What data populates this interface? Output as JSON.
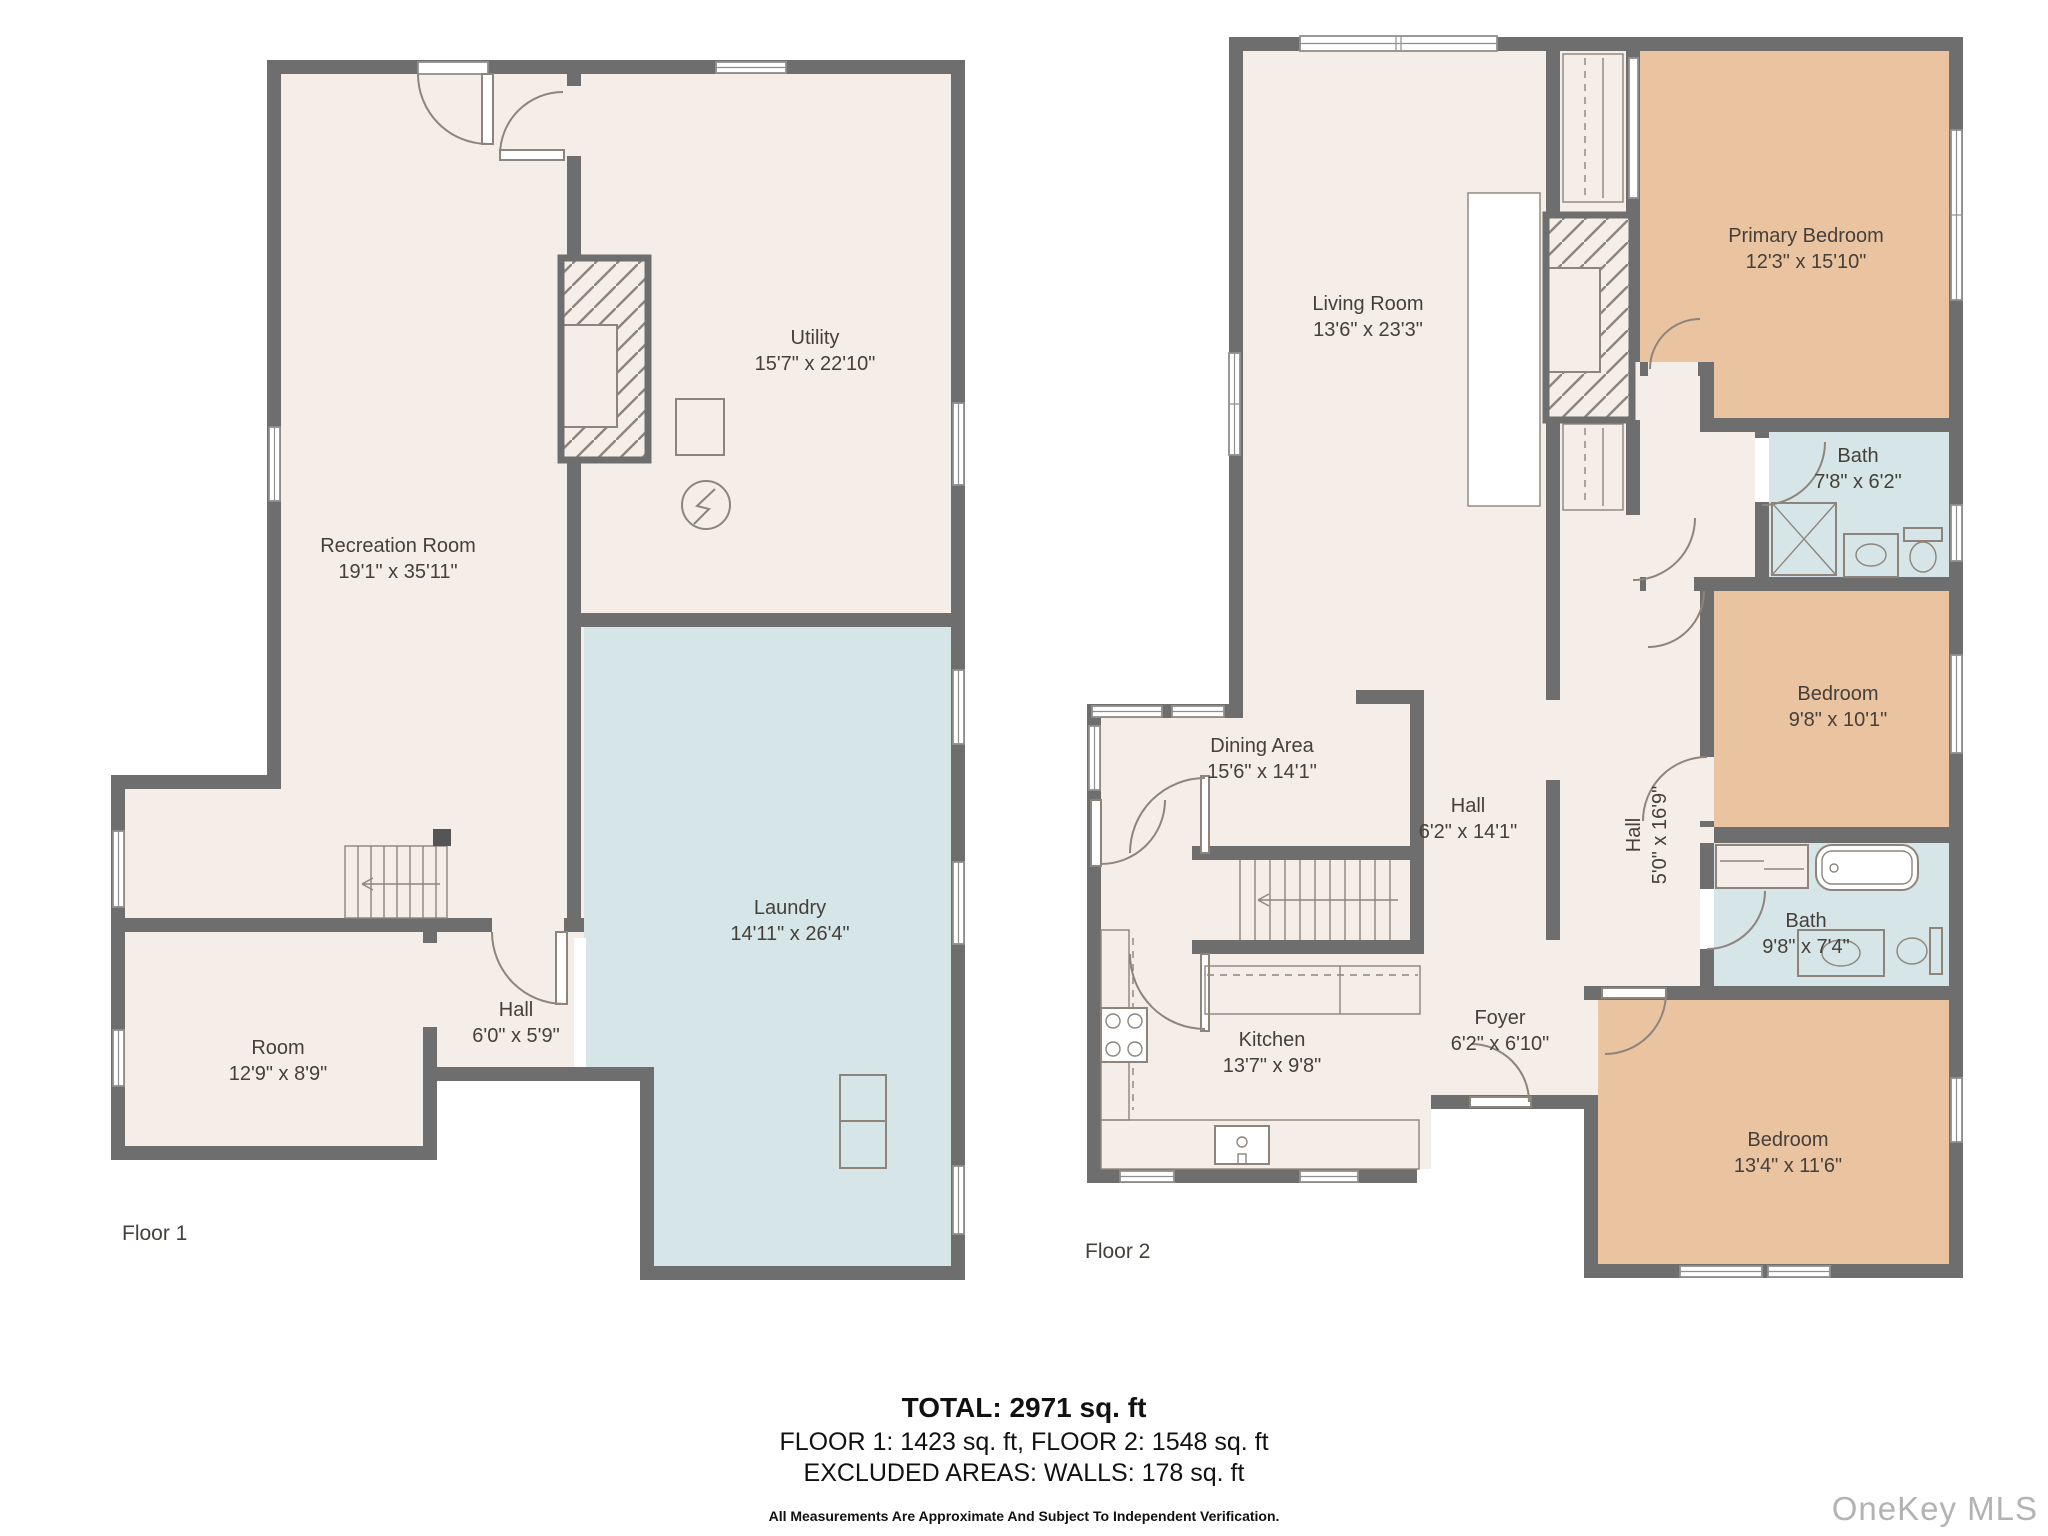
{
  "watermark": {
    "text": "OneKey MLS"
  },
  "colors": {
    "cream": "#f5ede7",
    "tan": "#eac3a1",
    "blue": "#d6e5e8",
    "wall": "#6e6e6e",
    "line": "#8d857c",
    "winstroke": "#8f8f8f",
    "text": "#45403a",
    "watermark": "#b3b3b3"
  },
  "floor1": {
    "label": "Floor 1",
    "rooms": [
      {
        "name": "Recreation Room",
        "dims": "19'1\" x 35'11\""
      },
      {
        "name": "Utility",
        "dims": "15'7\" x 22'10\""
      },
      {
        "name": "Laundry",
        "dims": "14'11\" x 26'4\""
      },
      {
        "name": "Hall",
        "dims": "6'0\" x 5'9\""
      },
      {
        "name": "Room",
        "dims": "12'9\" x 8'9\""
      }
    ]
  },
  "floor2": {
    "label": "Floor 2",
    "rooms": [
      {
        "name": "Living Room",
        "dims": "13'6\" x 23'3\""
      },
      {
        "name": "Primary Bedroom",
        "dims": "12'3\" x 15'10\""
      },
      {
        "name": "Bath",
        "dims": "7'8\" x 6'2\""
      },
      {
        "name": "Bedroom",
        "dims": "9'8\" x 10'1\""
      },
      {
        "name": "Dining Area",
        "dims": "15'6\" x 14'1\""
      },
      {
        "name": "Hall",
        "dims": "6'2\" x 14'1\""
      },
      {
        "name": "Hall",
        "dims": "5'0\" x 16'9\""
      },
      {
        "name": "Bath",
        "dims": "9'8\" x 7'4\""
      },
      {
        "name": "Kitchen",
        "dims": "13'7\" x 9'8\""
      },
      {
        "name": "Foyer",
        "dims": "6'2\" x 6'10\""
      },
      {
        "name": "Bedroom",
        "dims": "13'4\" x 11'6\""
      }
    ]
  },
  "summary": {
    "total": "TOTAL: 2971 sq. ft",
    "floors": "FLOOR 1: 1423 sq. ft, FLOOR 2: 1548 sq. ft",
    "excluded": "EXCLUDED AREAS: WALLS: 178 sq. ft",
    "disclaimer": "All Measurements Are Approximate And Subject To Independent Verification."
  }
}
